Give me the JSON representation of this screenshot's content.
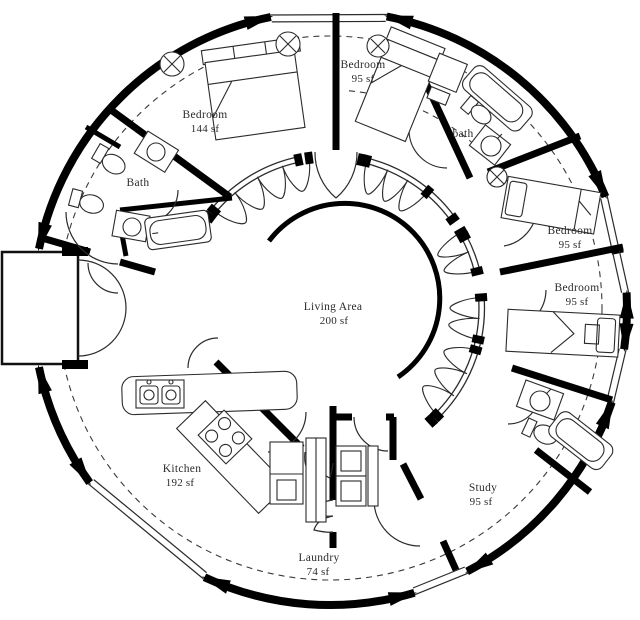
{
  "plan": {
    "type": "circular dome home floor plan",
    "colors": {
      "walls": "#000000",
      "background": "#ffffff",
      "label_text": "#2b2b2b"
    },
    "rooms": [
      {
        "id": "bedroom-nw",
        "name": "Bedroom",
        "area": "144 sf"
      },
      {
        "id": "bedroom-n",
        "name": "Bedroom",
        "area": "95 sf"
      },
      {
        "id": "bath-ne",
        "name": "bath",
        "area": ""
      },
      {
        "id": "bedroom-e-upper",
        "name": "Bedroom",
        "area": "95 sf"
      },
      {
        "id": "bedroom-e-lower",
        "name": "Bedroom",
        "area": "95 sf"
      },
      {
        "id": "bath-w",
        "name": "Bath",
        "area": ""
      },
      {
        "id": "living-area",
        "name": "Living Area",
        "area": "200 sf"
      },
      {
        "id": "kitchen",
        "name": "Kitchen",
        "area": "192 sf"
      },
      {
        "id": "laundry",
        "name": "Laundry",
        "area": "74 sf"
      },
      {
        "id": "study",
        "name": "Study",
        "area": "95 sf"
      }
    ]
  }
}
